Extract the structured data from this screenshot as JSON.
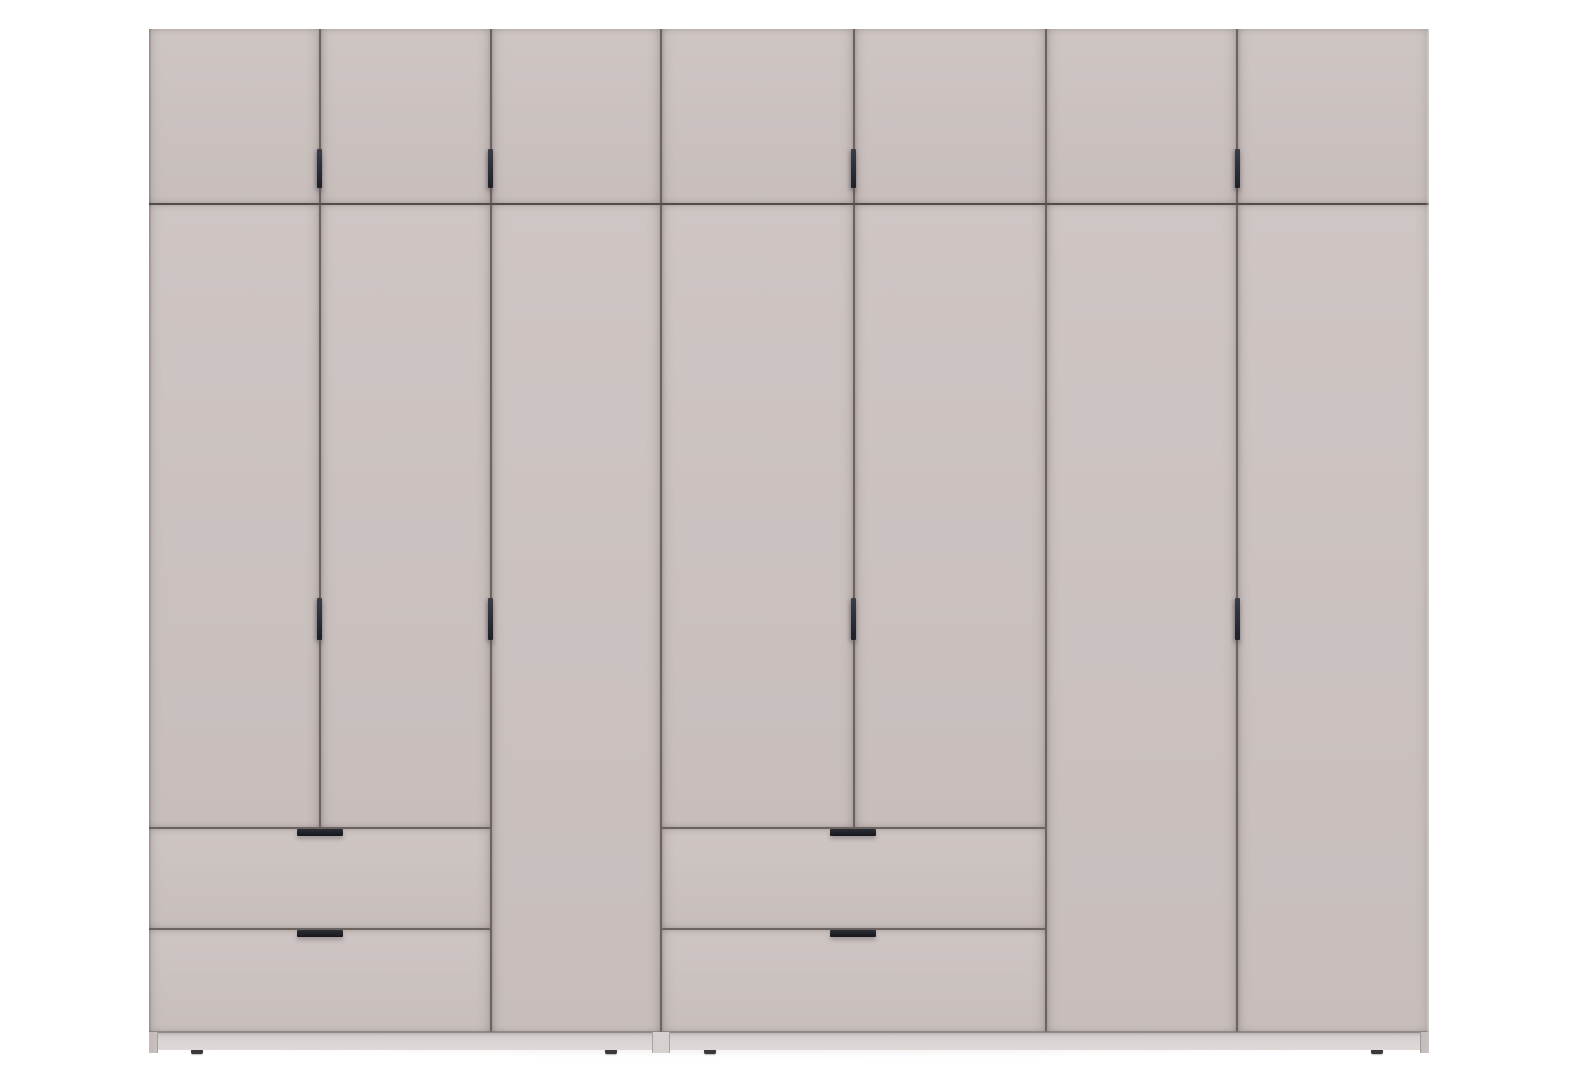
{
  "image": {
    "type": "product-render",
    "subject": "Seven-door wardrobe with overhead cabinets, four drawers and slim dark bar handles",
    "background_color": "#ffffff"
  },
  "wardrobe": {
    "finish": "matte cashmere grey",
    "units": [
      {
        "id": "left-unit",
        "top_doors": 3,
        "main_doors": 2,
        "tall_doors": 1,
        "drawers": 2
      },
      {
        "id": "right-unit",
        "top_doors": 4,
        "main_doors": 2,
        "tall_doors": 2,
        "drawers": 2
      }
    ],
    "totals": {
      "top_doors": 7,
      "wardrobe_doors": 7,
      "drawers": 4,
      "vertical_door_handles": 8,
      "horizontal_drawer_handles": 4,
      "visible_feet": 4
    },
    "handle_style": "slim dark vertical bar on doors, slim dark horizontal bar on drawers"
  },
  "colors": {
    "bg": "#ffffff",
    "body": "#cbc2c0",
    "line-v": "#6b6360",
    "line-h": "#514c4a",
    "edge-line": "#7d7673",
    "handle": "#22252d",
    "plinth": "#dad4d2",
    "leg": "#c9c2c0",
    "seam": "#d6d0ce",
    "foot": "#39393c"
  }
}
